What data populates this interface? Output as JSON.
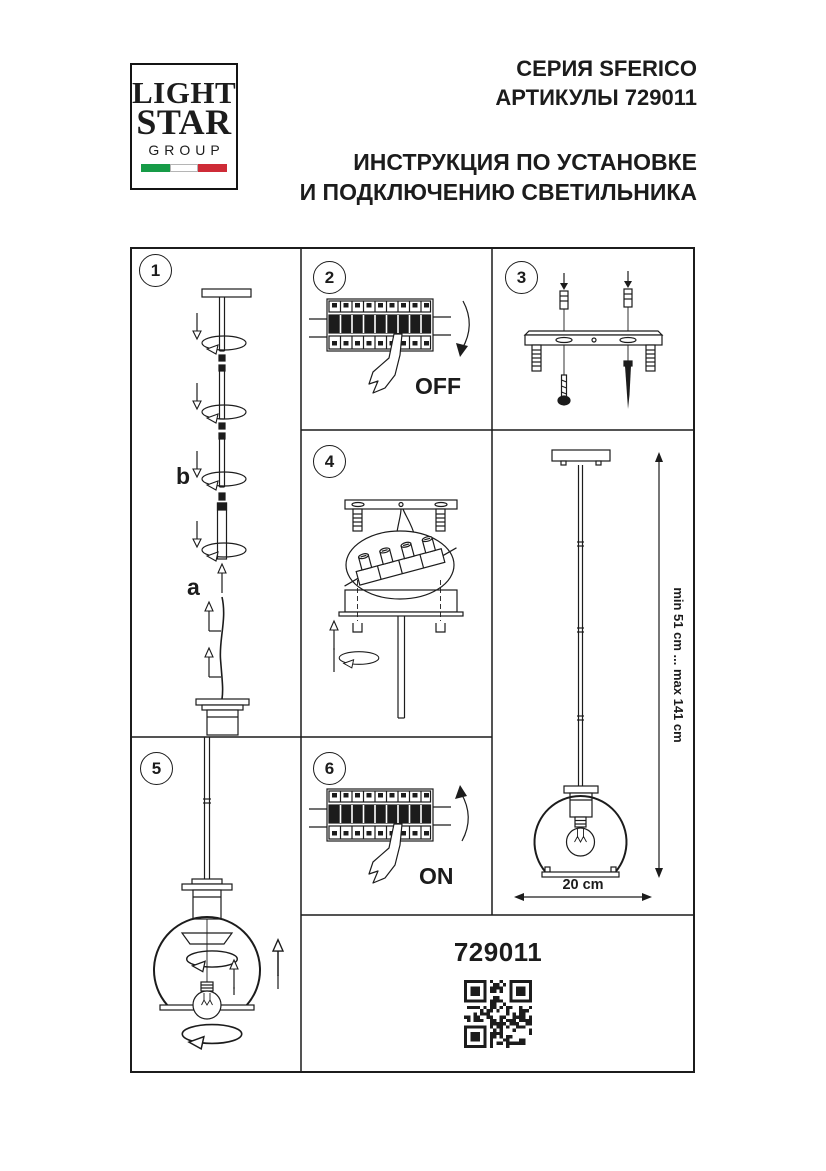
{
  "logo": {
    "line1": "LIGHT",
    "line2": "STAR",
    "line3": "GROUP"
  },
  "header": {
    "series": "СЕРИЯ SFERICO",
    "article": "АРТИКУЛЫ 729011",
    "title_line1": "ИНСТРУКЦИЯ ПО УСТАНОВКЕ",
    "title_line2": "И ПОДКЛЮЧЕНИЮ СВЕТИЛЬНИКА"
  },
  "steps": {
    "s1": {
      "number": "1",
      "label_b": "b",
      "label_a": "a"
    },
    "s2": {
      "number": "2",
      "state": "OFF"
    },
    "s3": {
      "number": "3"
    },
    "s4": {
      "number": "4"
    },
    "s5": {
      "number": "5"
    },
    "s6": {
      "number": "6",
      "state": "ON"
    }
  },
  "dimensions": {
    "height_range": "min 51 cm ... max 141 cm",
    "width": "20 cm"
  },
  "footer": {
    "article_number": "729011"
  },
  "colors": {
    "ink": "#1c1c1c",
    "flag_green": "#169B47",
    "flag_white": "#FFFFFF",
    "flag_red": "#CE2B37"
  }
}
